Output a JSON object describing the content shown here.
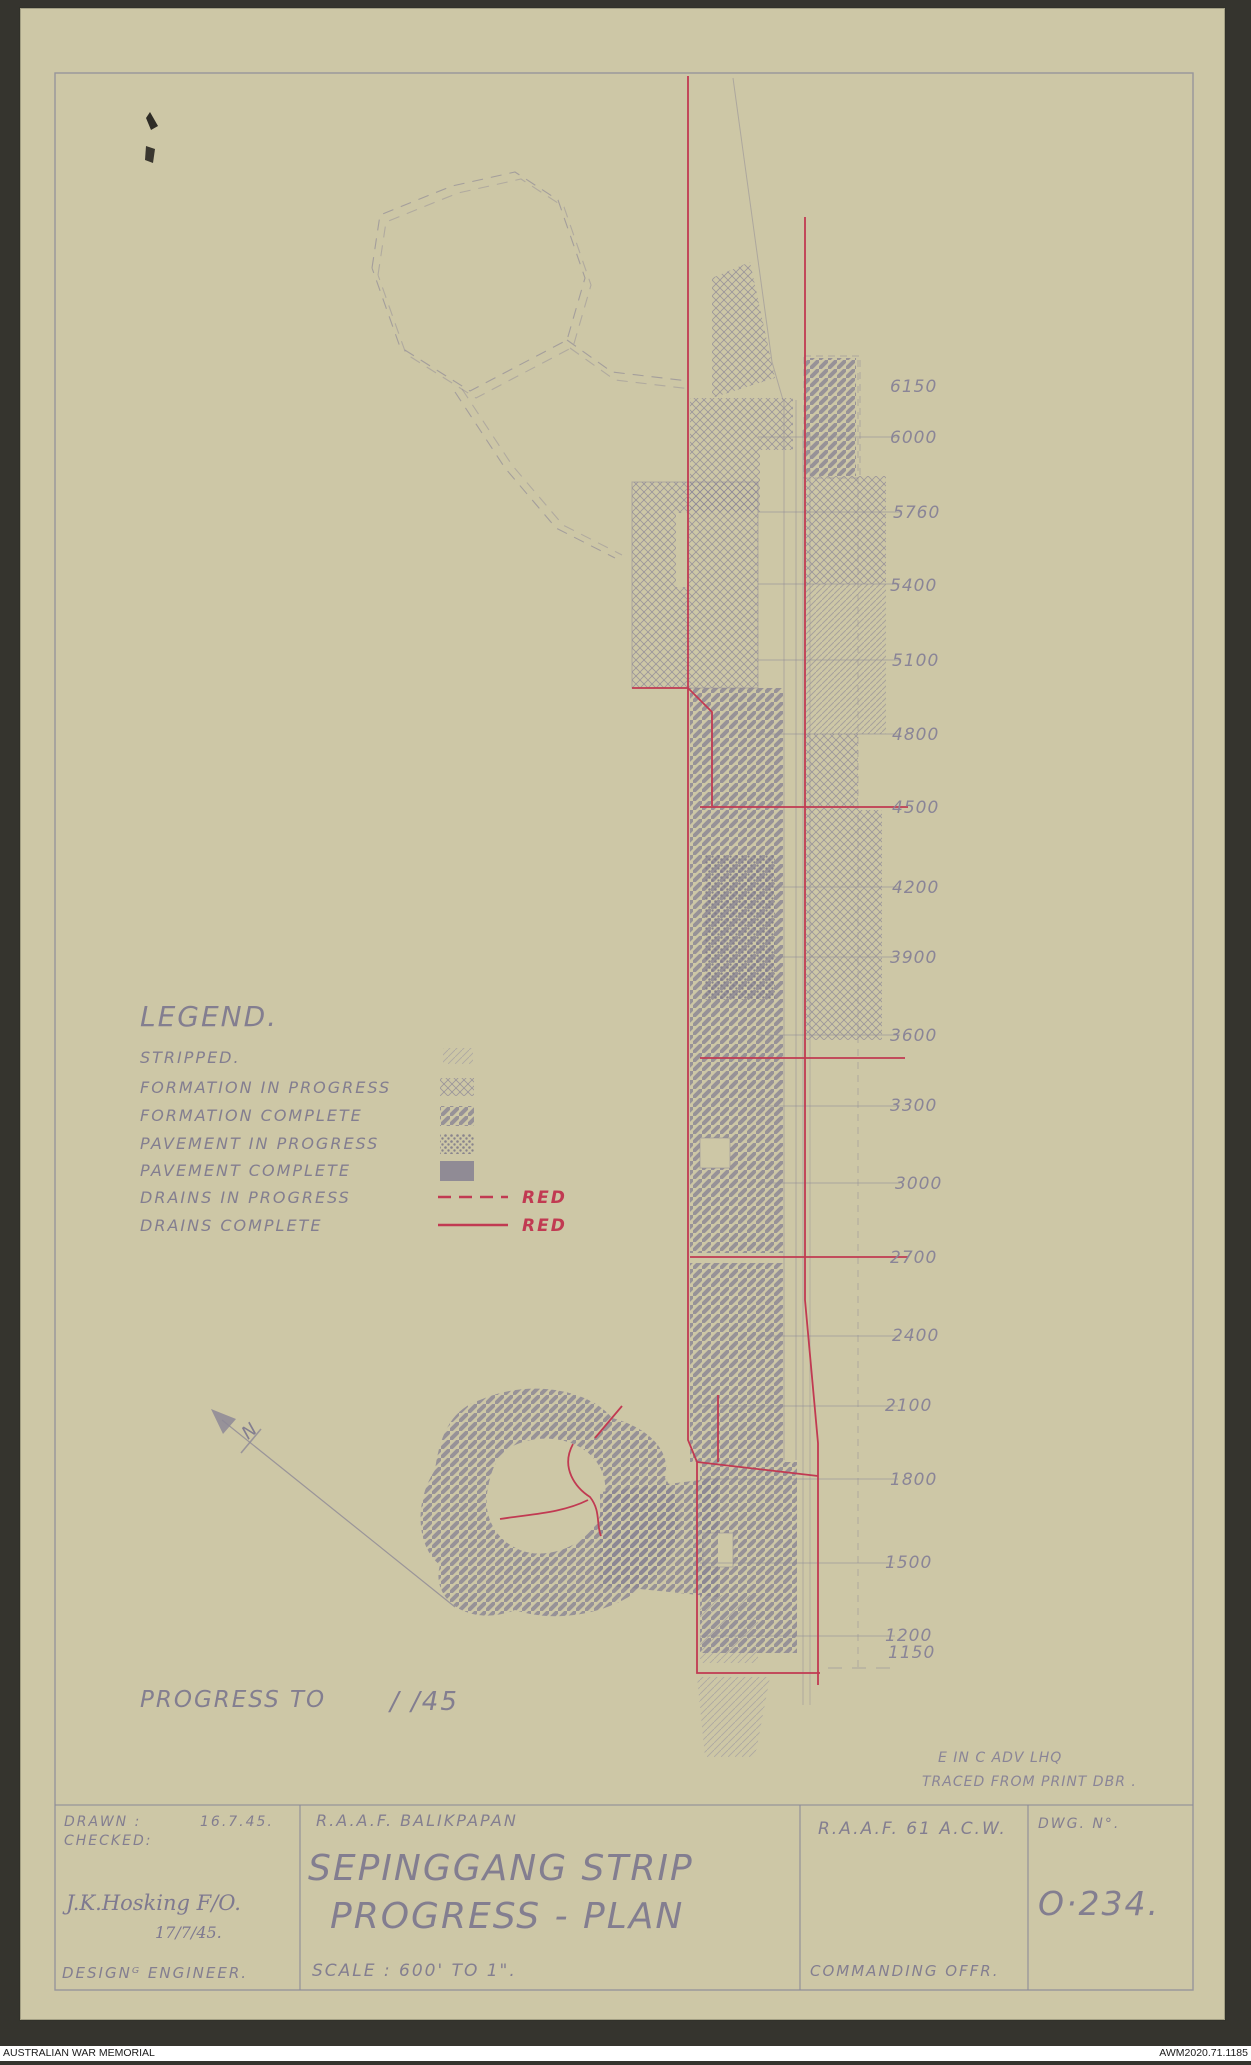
{
  "colors": {
    "background": "#35342e",
    "paper": "#cdc7a6",
    "pencil": "#8b8695",
    "red": "#c13a52",
    "footer_bg": "#ffffff"
  },
  "legend": {
    "title": "LEGEND.",
    "red_label": "RED",
    "items": [
      {
        "label": "STRIPPED.",
        "swatch": "stripped-hatch"
      },
      {
        "label": "FORMATION IN PROGRESS",
        "swatch": "crosshatch"
      },
      {
        "label": "FORMATION COMPLETE",
        "swatch": "dark-diagonal-hatch"
      },
      {
        "label": "PAVEMENT IN PROGRESS",
        "swatch": "dark-stipple"
      },
      {
        "label": "PAVEMENT COMPLETE",
        "swatch": "solid"
      },
      {
        "label": "DRAINS IN PROGRESS",
        "swatch": "red-dashed-line"
      },
      {
        "label": "DRAINS COMPLETE",
        "swatch": "red-solid-line"
      }
    ]
  },
  "stations": [
    {
      "label": "6150"
    },
    {
      "label": "6000"
    },
    {
      "label": "5760"
    },
    {
      "label": "5400"
    },
    {
      "label": "5100"
    },
    {
      "label": "4800"
    },
    {
      "label": "4500"
    },
    {
      "label": "4200"
    },
    {
      "label": "3900"
    },
    {
      "label": "3600"
    },
    {
      "label": "3300"
    },
    {
      "label": "3000"
    },
    {
      "label": "2700"
    },
    {
      "label": "2400"
    },
    {
      "label": "2100"
    },
    {
      "label": "1800"
    },
    {
      "label": "1500"
    },
    {
      "label": "1200"
    },
    {
      "label": "1150"
    }
  ],
  "progress": {
    "label": "PROGRESS TO",
    "value": "/      /45"
  },
  "tracing_note": {
    "line1": "E IN C   ADV   LHQ",
    "line2": "TRACED FROM PRINT DBR ."
  },
  "north_label": "N",
  "title_block": {
    "drawn_label": "DRAWN :",
    "drawn_date": "16.7.45.",
    "checked_label": "CHECKED:",
    "signature": "J.K.Hosking F/O.",
    "signature_date": "17/7/45.",
    "role": "DESIGNᴳ ENGINEER.",
    "project": "R.A.A.F.   BALIKPAPAN",
    "title_line1": "SEPINGGANG STRIP",
    "title_line2": "PROGRESS - PLAN",
    "scale": "SCALE : 600' TO 1\".",
    "unit": "R.A.A.F.   61 A.C.W.",
    "officer": "COMMANDING OFFR.",
    "dwg_label": "DWG. N°.",
    "dwg_number": "O·234."
  },
  "footer": {
    "left": "AUSTRALIAN WAR MEMORIAL",
    "right": "AWM2020.71.1185"
  }
}
